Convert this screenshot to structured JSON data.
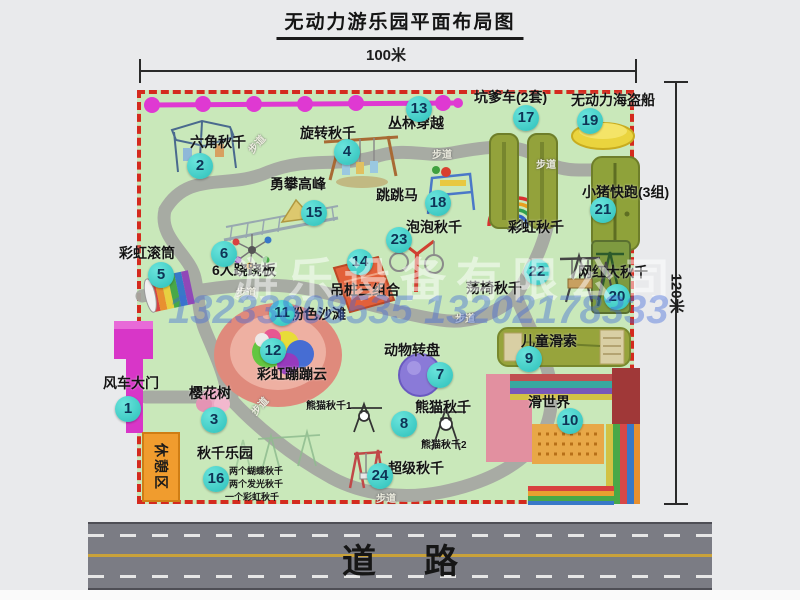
{
  "title": "无动力游乐园平面布局图",
  "dimensions": {
    "width": "100米",
    "height": "120米"
  },
  "road_label": "道路",
  "rest_area": "休憩区",
  "footpath": "步道",
  "watermark": {
    "company": "游乐设备有限公司",
    "phone": "13233808535 13202178333"
  },
  "attractions": [
    {
      "num": "1",
      "label": "风车大门"
    },
    {
      "num": "2",
      "label": "六角秋千"
    },
    {
      "num": "3",
      "label": "樱花树"
    },
    {
      "num": "4",
      "label": "旋转秋千"
    },
    {
      "num": "5",
      "label": "彩虹滚筒"
    },
    {
      "num": "6",
      "label": "6人跷跷板"
    },
    {
      "num": "7",
      "label": "动物转盘"
    },
    {
      "num": "8",
      "label": "熊猫秋千"
    },
    {
      "num": "9",
      "label": "儿童滑索"
    },
    {
      "num": "10",
      "label": "滑世界"
    },
    {
      "num": "11",
      "label": "粉色沙滩"
    },
    {
      "num": "12",
      "label": "彩虹蹦蹦云"
    },
    {
      "num": "13",
      "label": "丛林穿越"
    },
    {
      "num": "14",
      "label": "吊桩三组合"
    },
    {
      "num": "15",
      "label": "勇攀高峰"
    },
    {
      "num": "16",
      "label": "秋千乐园"
    },
    {
      "num": "17",
      "label": "坑爹车(2套)"
    },
    {
      "num": "18",
      "label": "跳跳马"
    },
    {
      "num": "19",
      "label": "无动力海盗船"
    },
    {
      "num": "20",
      "label": "网红大秋千"
    },
    {
      "num": "21",
      "label": "小猪快跑(3组)"
    },
    {
      "num": "22",
      "label": "荡椅秋千"
    },
    {
      "num": "23",
      "label": "泡泡秋千"
    },
    {
      "num": "24",
      "label": "超级秋千"
    }
  ],
  "extra_labels": {
    "rainbow_swing": "彩虹秋千",
    "panda_swing_1": "熊猫秋千1",
    "panda_swing_2": "熊猫秋千2",
    "swing_park_notes": [
      "两个蝴蝶秋千",
      "两个发光秋千",
      "一个彩虹秋千"
    ]
  },
  "colors": {
    "map_bg": "#c9e8ba",
    "border_dashed": "#d42a1e",
    "badge": "#3fd4cc",
    "road": "#7b7c84",
    "gate": "#d836c8",
    "chain": "#df39d2"
  }
}
